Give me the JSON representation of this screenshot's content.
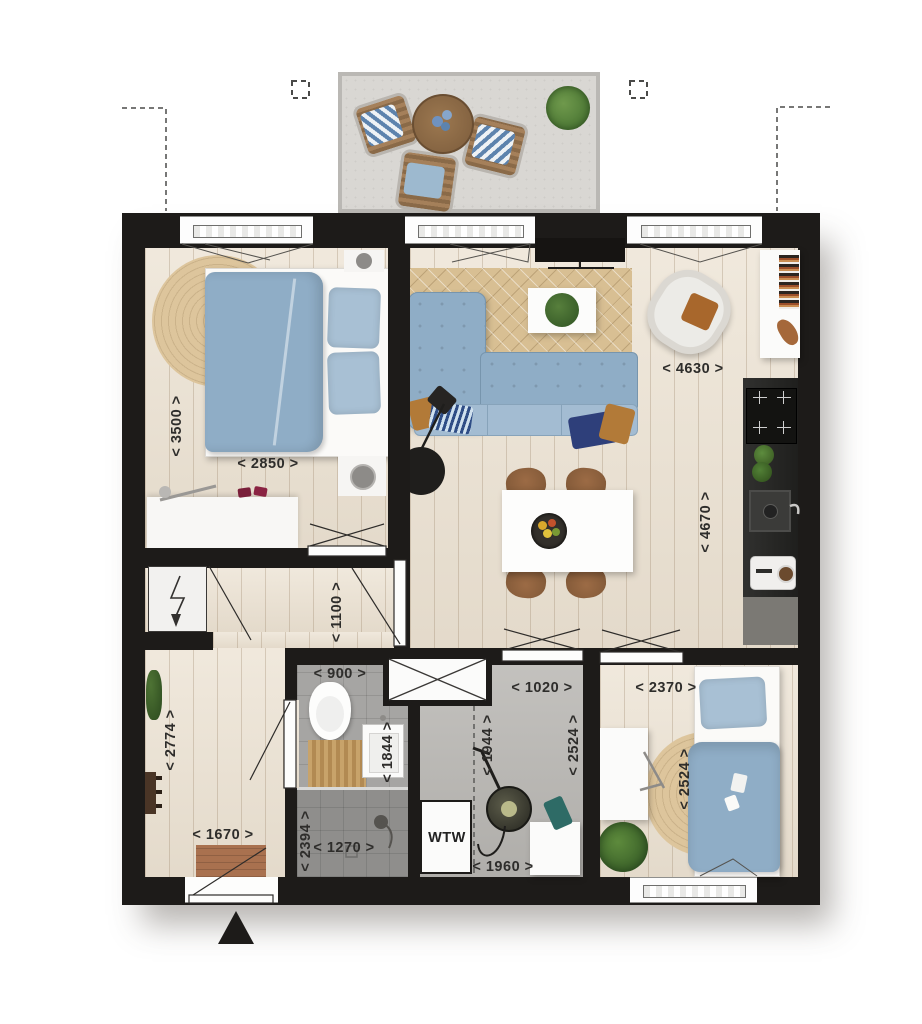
{
  "plan": {
    "type": "apartment-floorplan-top-view",
    "entrance_marker": "triangle-up"
  },
  "dimensions": {
    "bedroom_main": {
      "width": "< 2850 >",
      "depth": "< 3500 >"
    },
    "living_room": {
      "width": "< 4630 >",
      "depth": "< 4670 >"
    },
    "hall": {
      "passage": "< 1100 >",
      "width": "< 1670 >",
      "depth": "< 2774 >"
    },
    "bathroom": {
      "width": "< 900 >",
      "sink_zone": "< 1844 >",
      "depth": "< 2394 >",
      "shower_width": "< 1270 >"
    },
    "tech_room": {
      "width": "< 1020 >",
      "clear_depth": "< 1944 >",
      "depth": "< 2524 >",
      "bottom_width": "< 1960 >"
    },
    "bedroom_second": {
      "width": "< 2370 >",
      "depth": "< 2524 >"
    }
  },
  "appliances": {
    "heat_recovery_unit": "WTW"
  },
  "colors": {
    "wall": "#1d1b19",
    "wood_floor": "#ebe1d1",
    "tile_floor": "#a6a5a3",
    "screed_floor": "#b9b7b3",
    "balcony_floor": "#d9d7d3",
    "textile_blue": "#8fadc6",
    "rug_jute": "#d8bf93",
    "kitchen_counter": "#242422"
  }
}
